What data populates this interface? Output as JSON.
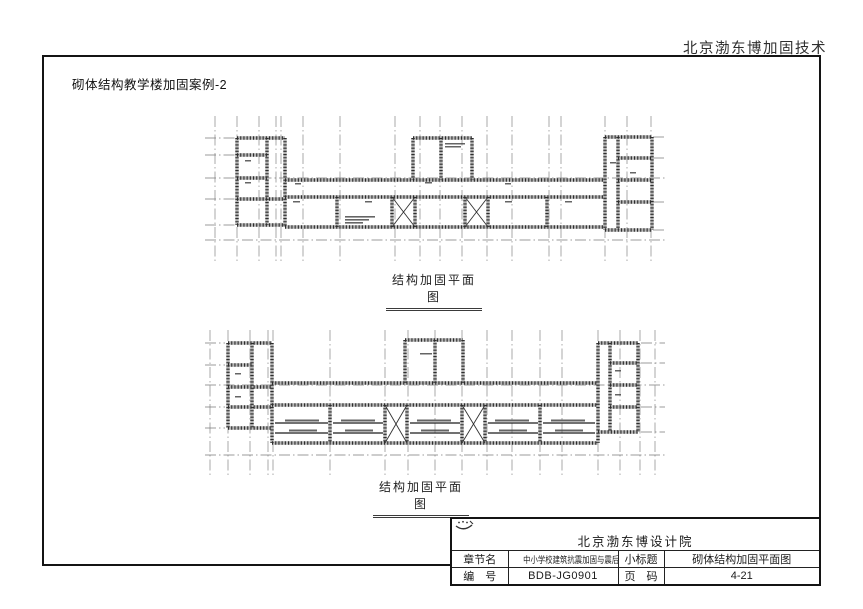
{
  "page": {
    "header": "北京渤东博加固技术",
    "title": "砌体结构教学楼加固案例-2"
  },
  "plans": {
    "top": {
      "caption": "结构加固平面图"
    },
    "bottom": {
      "caption": "结构加固平面图"
    }
  },
  "titleblock": {
    "logo_icon": "institute-logo-icon",
    "company": "北京渤东博设计院",
    "rows": [
      {
        "c1": "章节名",
        "c2": "中小学校建筑抗震加固与震后恢复",
        "c3": "小标题",
        "c4": "砌体结构加固平面图"
      },
      {
        "c1": "编　号",
        "c2": "BDB-JG0901",
        "c3": "页　码",
        "c4": "4-21"
      }
    ]
  }
}
